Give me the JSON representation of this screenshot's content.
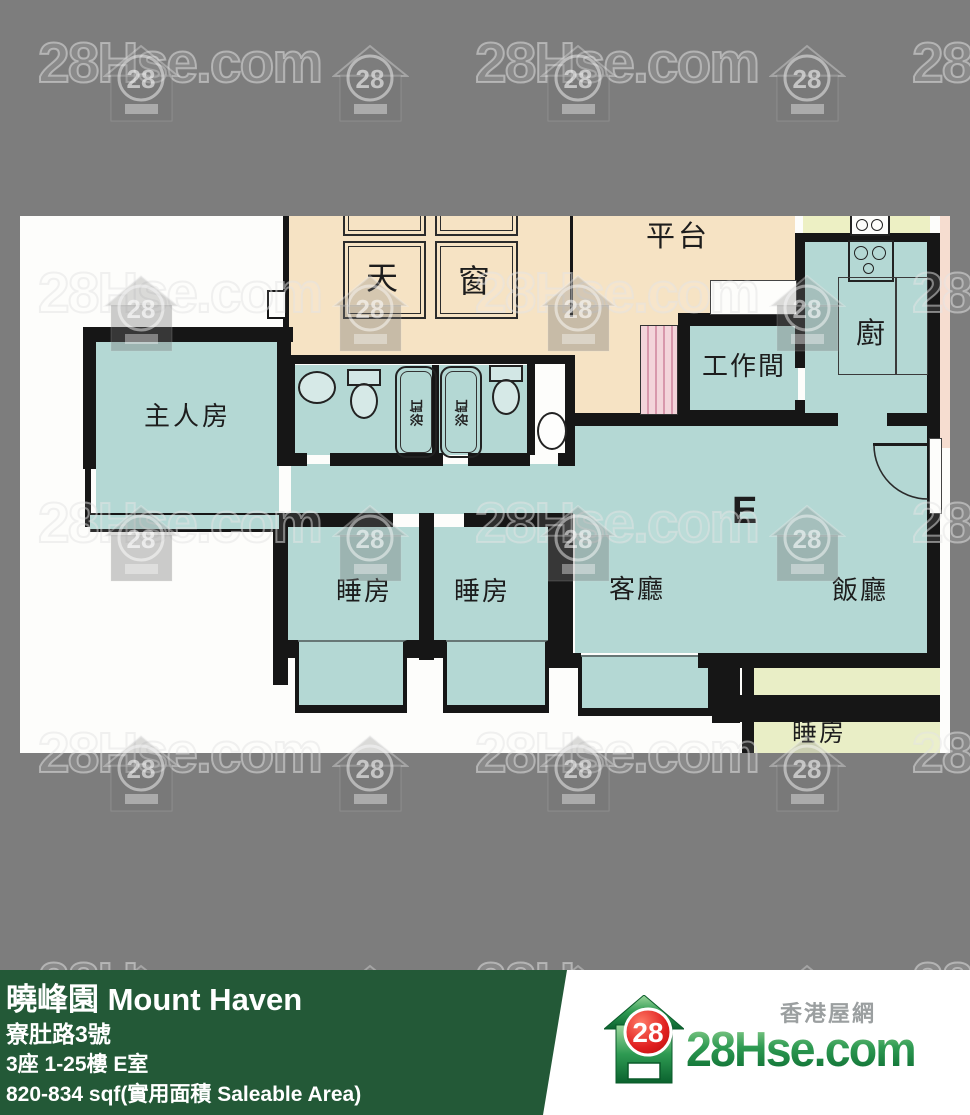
{
  "watermark": {
    "text": "28Hse.com",
    "badge": "28"
  },
  "plan": {
    "unit_letter": "E",
    "labels": {
      "skylight_a": "天",
      "skylight_b": "窗",
      "terrace": "平台",
      "kitchen": "廚",
      "utility_room": "工作間",
      "master_bedroom": "主人房",
      "bedroom_1": "睡房",
      "bedroom_2": "睡房",
      "living_room": "客廳",
      "dining_room": "飯廳",
      "bathtub_1": "浴缸",
      "bathtub_2": "浴缸",
      "adjacent_bedroom": "睡房"
    }
  },
  "footer": {
    "title": "曉峰園 Mount Haven",
    "address": "寮肚路3號",
    "unit_info": "3座 1-25樓 E室",
    "area": "820-834 sqf(實用面積 Saleable Area)",
    "logo": {
      "badge": "28",
      "site": "28Hse.com",
      "tagline": "香港屋網"
    }
  },
  "colors": {
    "background_gray": "#7d7d7d",
    "room_teal": "#b4d8d4",
    "terrace_beige": "#f6e3c4",
    "adjacent_pale_green": "#e9eec6",
    "wall_black": "#161616",
    "footer_green": "#235937",
    "logo_red": "#d81e1e",
    "logo_green": "#0a6a30"
  }
}
